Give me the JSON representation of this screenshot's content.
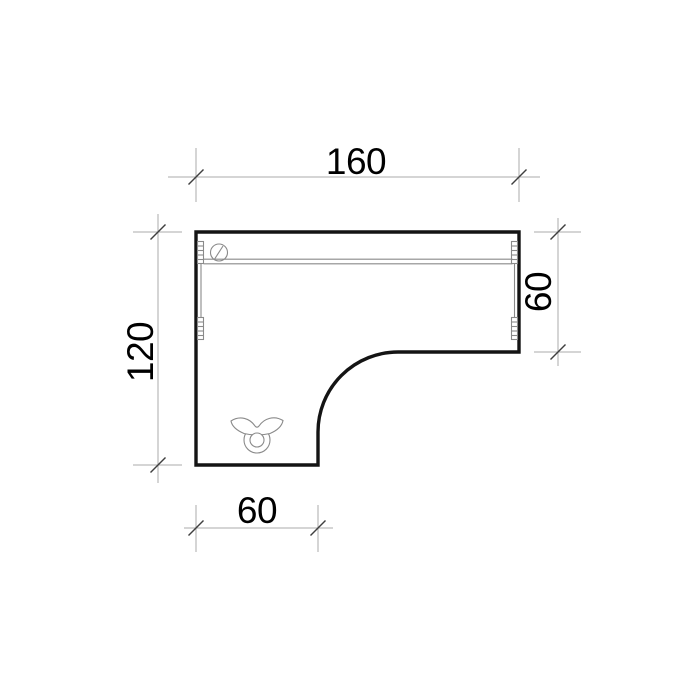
{
  "dimensions": {
    "top_width": {
      "label": "160"
    },
    "right_depth": {
      "label": "60"
    },
    "left_height": {
      "label": "120"
    },
    "bottom_width": {
      "label": "60"
    }
  },
  "icons": {
    "grommet": "cable-grommet-icon",
    "pedestal": "leg-base-icon"
  },
  "colors": {
    "background": "#ffffff",
    "outline": "#141414",
    "detail": "#8a8a8a",
    "dimension_line": "#ababab",
    "tick": "#3f3f3f",
    "text": "#000000"
  }
}
